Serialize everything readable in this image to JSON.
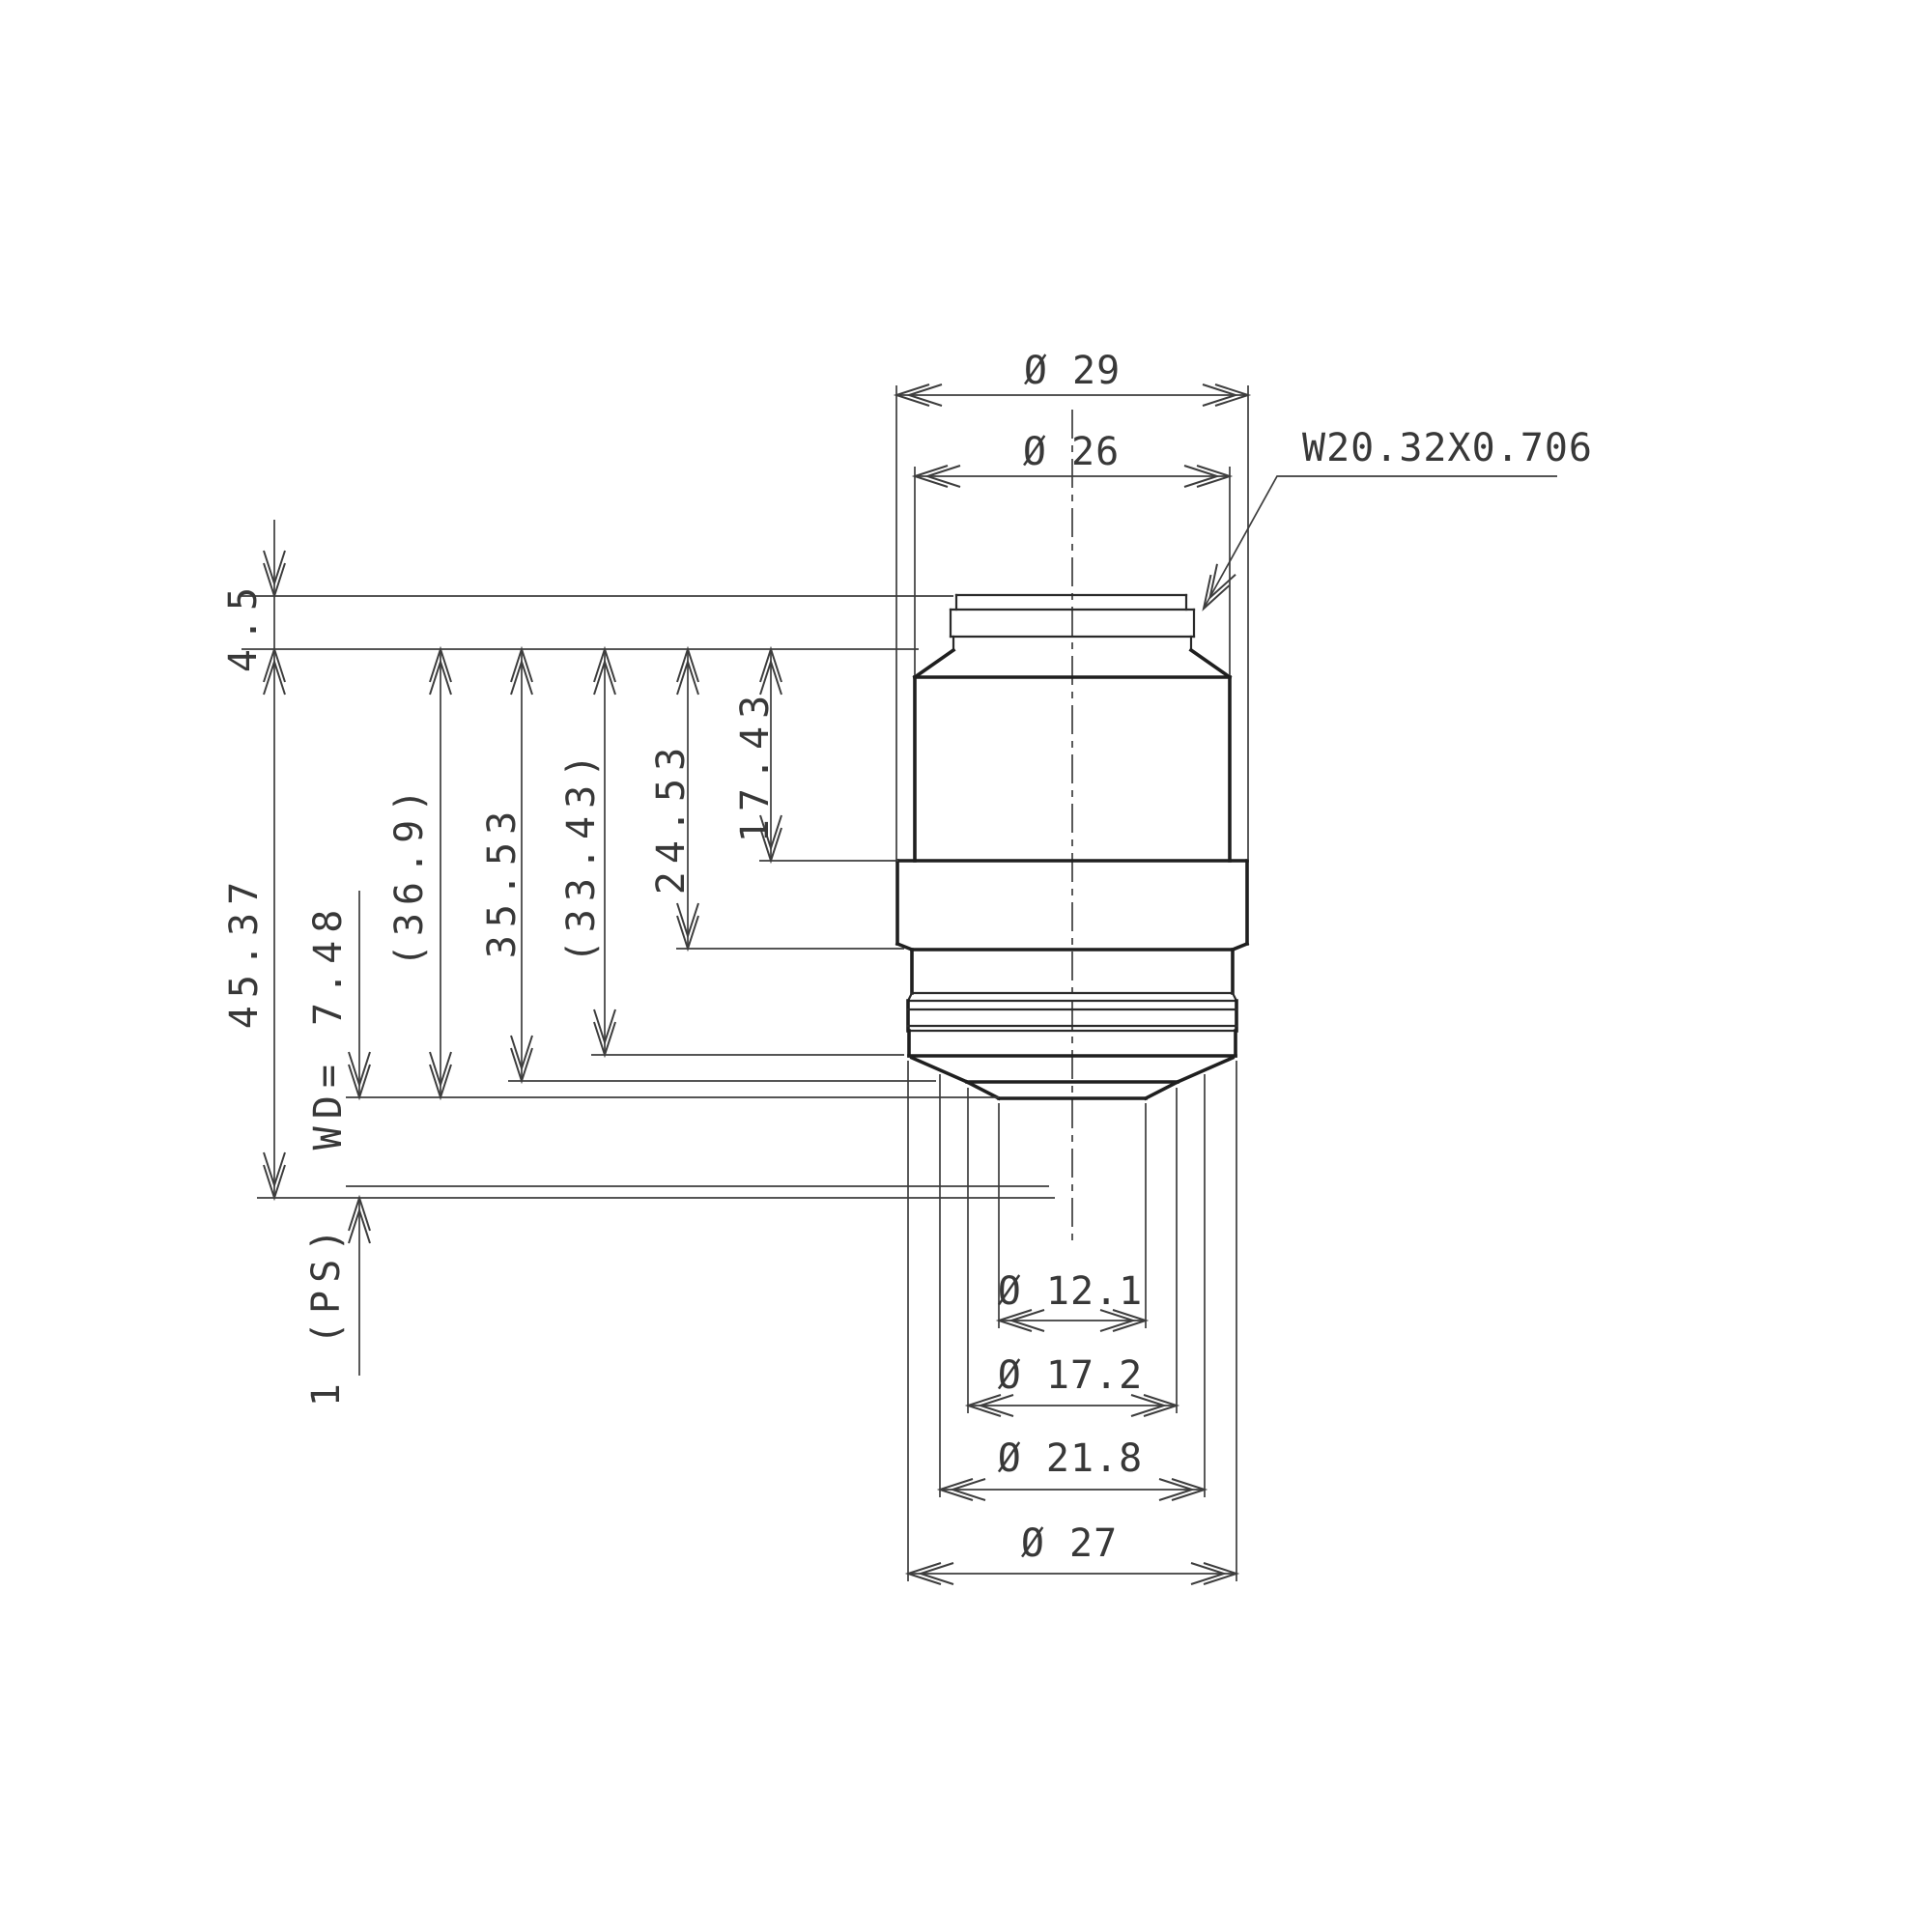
{
  "drawing": {
    "type": "technical-dimension-drawing",
    "subject": "microscope objective lens side view",
    "units": "mm",
    "line_color": "#1f1f1f",
    "dim_color": "#3d3d3d",
    "top_dims": {
      "outer": "Ø 29",
      "inner": "Ø 26"
    },
    "thread_spec": "W20.32X0.706",
    "left_dims": {
      "thread_length": "4.5",
      "parfocal": "45.37",
      "working_distance": "WD= 7.48",
      "len_36_9": "(36.9)",
      "len_35_53": "35.53",
      "len_33_43": "(33.43)",
      "len_24_53": "24.53",
      "len_17_43": "17.43",
      "plate": "1 (PS)"
    },
    "bottom_dims": {
      "tip": "Ø 12.1",
      "ring": "Ø 17.2",
      "cone": "Ø 21.8",
      "rim": "Ø 27"
    }
  }
}
